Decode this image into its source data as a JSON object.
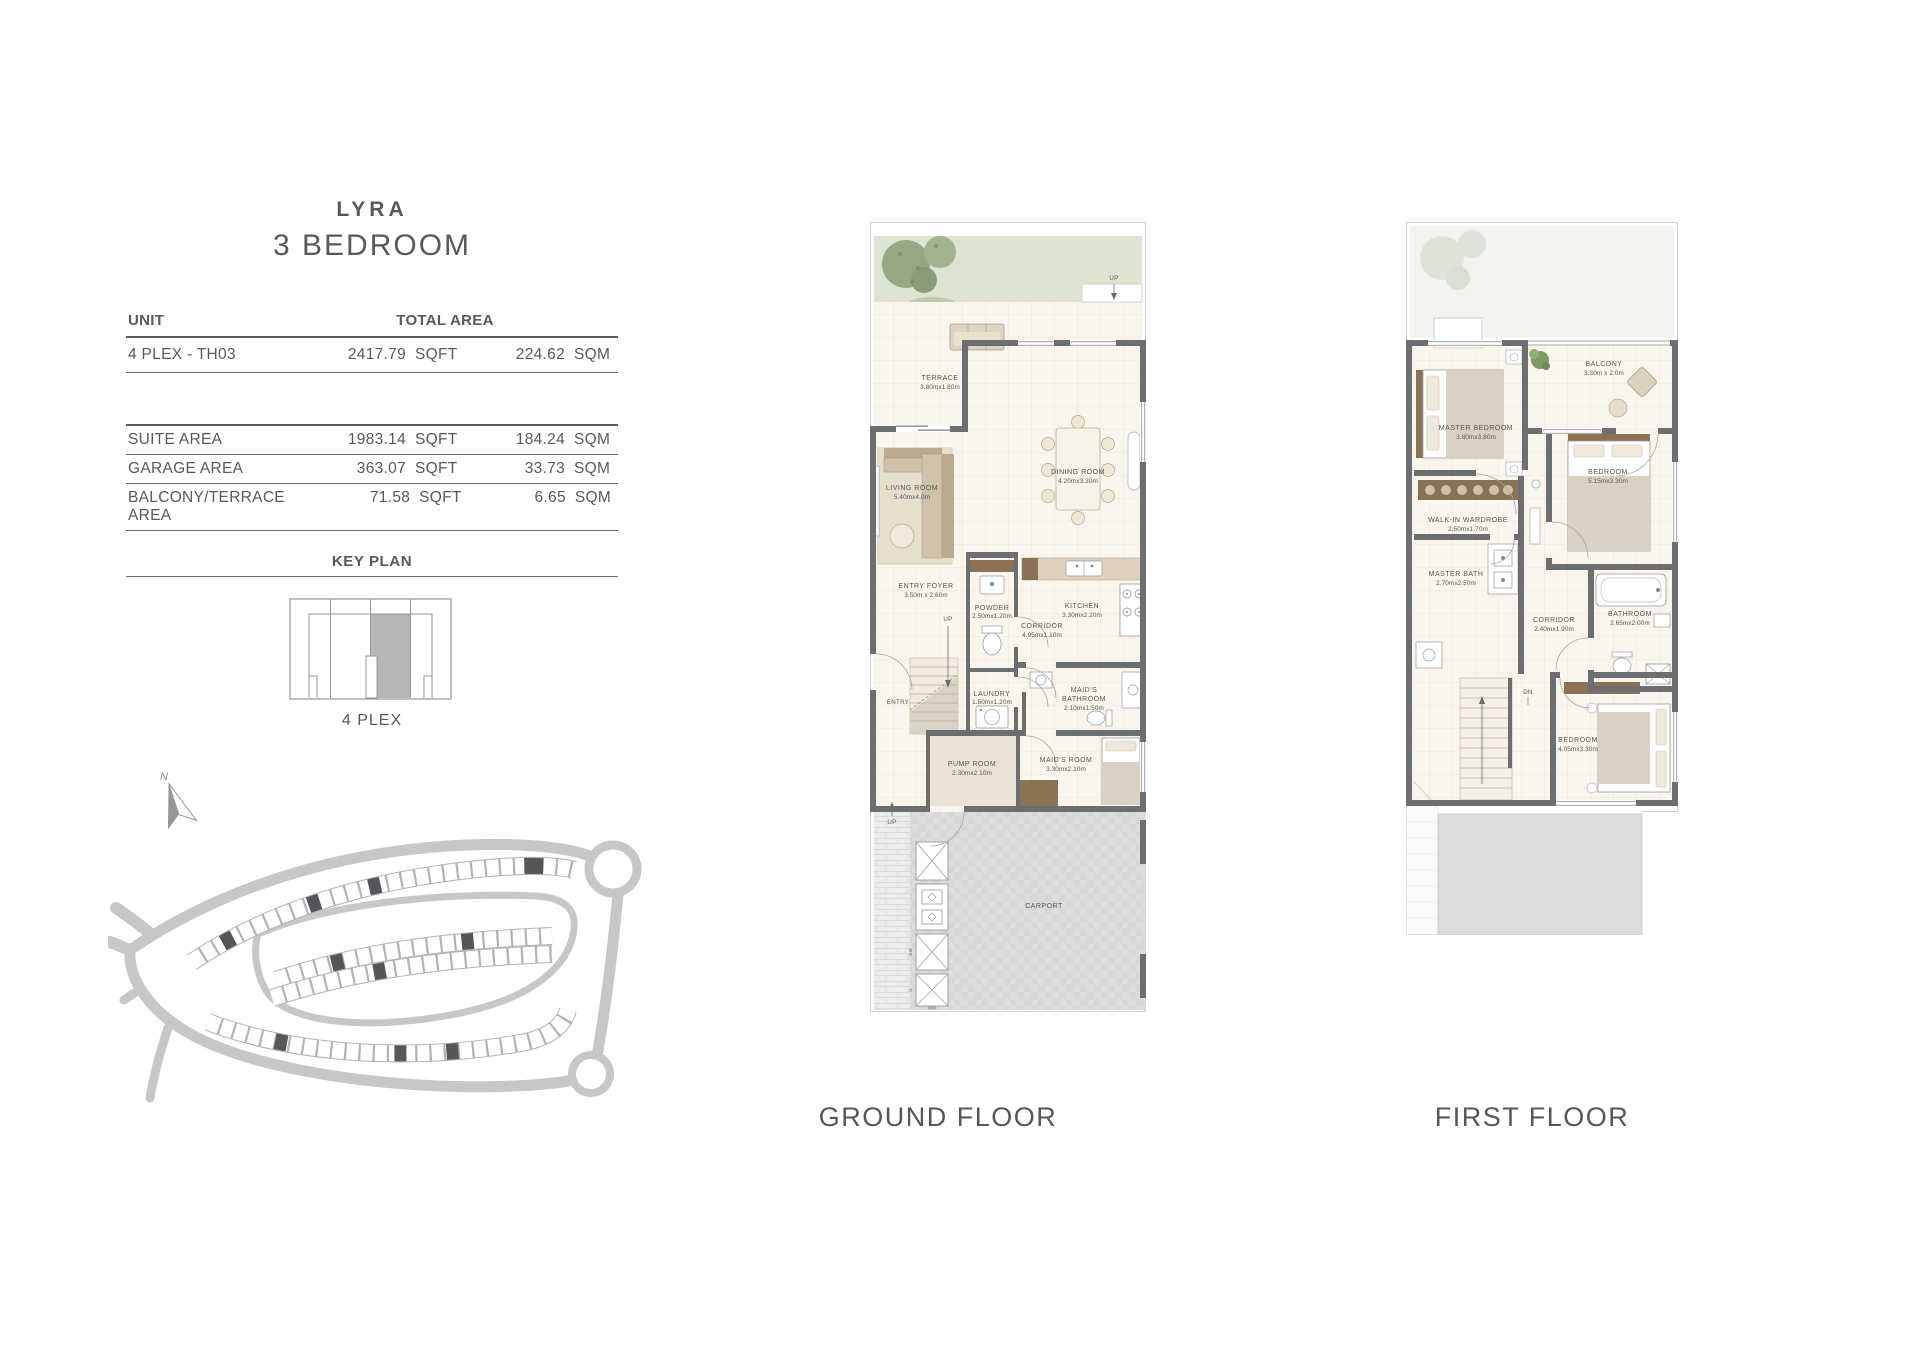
{
  "page": {
    "title": "LYRA",
    "subtitle": "3 BEDROOM"
  },
  "table": {
    "col_unit": "UNIT",
    "col_total": "TOTAL AREA",
    "unit_row": {
      "label": "4 PLEX - TH03",
      "sqft": "2417.79",
      "sqft_u": "SQFT",
      "sqm": "224.62",
      "sqm_u": "SQM"
    },
    "rows": [
      {
        "label": "SUITE AREA",
        "sqft": "1983.14",
        "sqft_u": "SQFT",
        "sqm": "184.24",
        "sqm_u": "SQM"
      },
      {
        "label": "GARAGE AREA",
        "sqft": "363.07",
        "sqft_u": "SQFT",
        "sqm": "33.73",
        "sqm_u": "SQM"
      },
      {
        "label": "BALCONY/TERRACE AREA",
        "sqft": "71.58",
        "sqft_u": "SQFT",
        "sqm": "6.65",
        "sqm_u": "SQM"
      }
    ],
    "key_plan_title": "KEY PLAN",
    "key_plan_caption": "4 PLEX"
  },
  "compass": {
    "label": "N"
  },
  "ground_floor": {
    "caption": "GROUND FLOOR",
    "entry": "ENTRY",
    "up_terrace": "UP",
    "up_stairs": "UP",
    "up_carport": "UP",
    "utilities": {
      "em": "EM",
      "g": "G",
      "wm": "WM"
    },
    "rooms": {
      "terrace": {
        "name": "TERRACE",
        "dims": "3.80mx1.80m"
      },
      "living": {
        "name": "LIVING ROOM",
        "dims": "5.40mx4.0m"
      },
      "dining": {
        "name": "DINING ROOM",
        "dims": "4.20mx3.30m"
      },
      "entry_foyer": {
        "name": "ENTRY FOYER",
        "dims": "3.50m x 2.60m"
      },
      "powder": {
        "name": "POWDER",
        "dims": "2.50mx1.20m"
      },
      "corridor": {
        "name": "CORRIDOR",
        "dims": "4.95mx1.10m"
      },
      "kitchen": {
        "name": "KITCHEN",
        "dims": "3.30mx2.20m"
      },
      "laundry": {
        "name": "LAUNDRY",
        "dims": "1.50mx1.20m"
      },
      "maids_bath": {
        "name1": "MAID'S",
        "name2": "BATHROOM",
        "dims": "2.10mx1.50m"
      },
      "pump": {
        "name": "PUMP ROOM",
        "dims": "2.30mx2.10m"
      },
      "maids_room": {
        "name": "MAID'S ROOM",
        "dims": "3.30mx2.10m"
      },
      "carport": {
        "name": "CARPORT"
      }
    }
  },
  "first_floor": {
    "caption": "FIRST FLOOR",
    "dn": "DN",
    "rooms": {
      "balcony": {
        "name": "BALCONY",
        "dims": "3.30m x 2.0m"
      },
      "master_bedroom": {
        "name": "MASTER BEDROOM",
        "dims": "3.80mx3.80m"
      },
      "bedroom_right": {
        "name": "BEDROOM",
        "dims": "5.15mx3.30m"
      },
      "wardrobe": {
        "name": "WALK-IN WARDROBE",
        "dims": "2.50mx1.70m"
      },
      "master_bath": {
        "name": "MASTER BATH",
        "dims": "2.70mx2.50m"
      },
      "corridor": {
        "name": "CORRIDOR",
        "dims": "2.40mx1.90m"
      },
      "bathroom": {
        "name": "BATHROOM",
        "dims": "2.65mx2.00m"
      },
      "bedroom_bottom": {
        "name": "BEDROOM",
        "dims": "4.05mx3.30m"
      }
    }
  },
  "colors": {
    "text": "#58595b",
    "wall": "#6d6e71",
    "floor": "#faf6ed",
    "grass": "#dde5d1",
    "carport": "#d6d7d6",
    "keyplan_shaded": "#b5b6b8",
    "road": "#c6c7c9",
    "dark_plot": "#55565a"
  }
}
